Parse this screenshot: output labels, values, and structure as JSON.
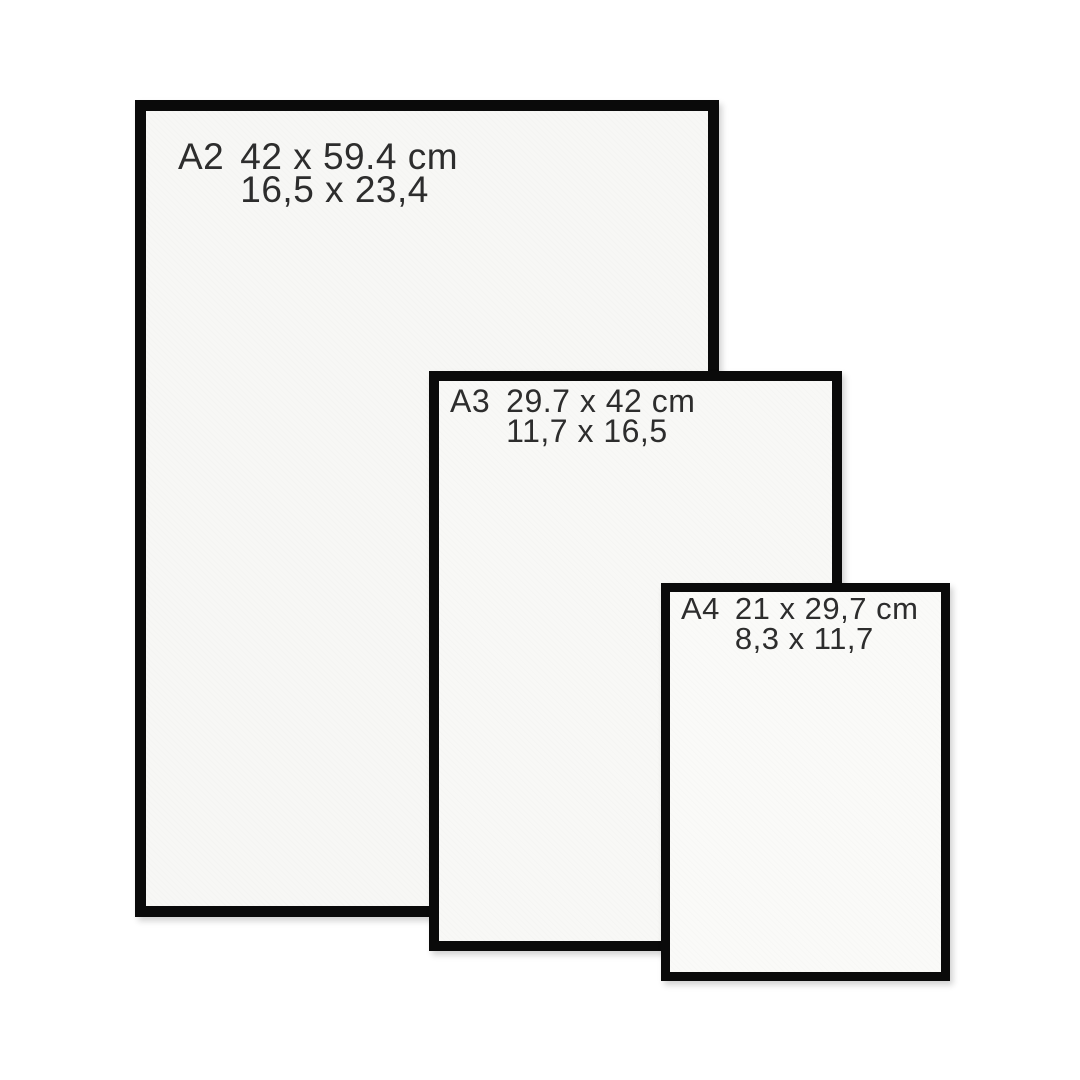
{
  "colors": {
    "background": "#ffffff",
    "frame_border": "#0a0a0a",
    "paper": "#f8f8f6",
    "text": "#2d2d2d"
  },
  "frames": [
    {
      "code": "A2",
      "dimensions_cm": "42 x 59.4 cm",
      "dimensions_in": "16,5 x 23,4"
    },
    {
      "code": "A3",
      "dimensions_cm": "29.7 x 42 cm",
      "dimensions_in": "11,7 x 16,5"
    },
    {
      "code": "A4",
      "dimensions_cm": "21 x 29,7 cm",
      "dimensions_in": "8,3 x 11,7"
    }
  ]
}
